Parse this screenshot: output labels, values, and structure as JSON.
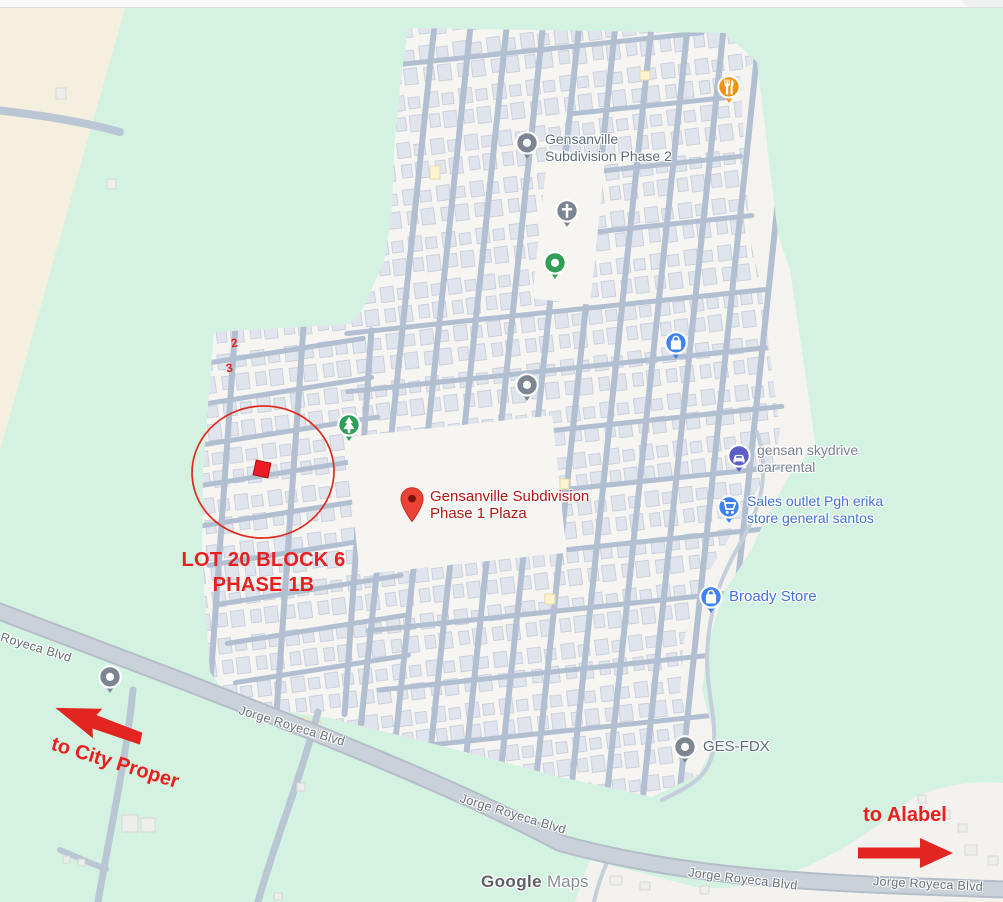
{
  "attribution": {
    "brand": "Google",
    "product": "Maps"
  },
  "road": {
    "jorge_royeca": "Jorge Royeca Blvd"
  },
  "pois": {
    "bogarts": {
      "name": "Bogart's Delectables"
    },
    "phase2_top": {
      "line1": "Gensanville",
      "line2": "Subdivision Phase 2"
    },
    "chapel": {
      "line1": "Gensanville Subdivision",
      "line2": "Phase 2 Chapel"
    },
    "basketball": {
      "line1": "Gensanville Subdivision",
      "line2": "Phase 2 Basketball Court"
    },
    "electrical": {
      "line1": "Gensan Online",
      "line2": "Electrical Sales"
    },
    "phase2_mid": {
      "line1": "Gensanville",
      "line2": "Subdivision Phase 2"
    },
    "plaza": {
      "line1": "Gensanville Subdivision",
      "line2": "Phase 1 Plaza"
    },
    "skydrive": {
      "line1": "gensan skydrive",
      "line2": "car rental"
    },
    "sales_outlet": {
      "line1": "Sales outlet Pgh erika",
      "line2": "store general santos"
    },
    "broady": {
      "name": "Broady Store"
    },
    "radyo": {
      "name": "Radyo GenSan"
    },
    "ges_fdx": {
      "name": "GES-FDX"
    }
  },
  "annotations": {
    "lot_line1": "LOT 20 BLOCK 6",
    "lot_line2": "PHASE 1B",
    "to_city_proper": "to City Proper",
    "to_alabel": "to Alabel",
    "block_number_2": "2",
    "block_number_3": "3"
  },
  "icons": {
    "restaurant": "fork-knife-icon",
    "generic_place": "dot-pin-icon",
    "chapel": "cross-pin-icon",
    "sports_court": "dot-pin-icon",
    "park": "tree-pin-icon",
    "shopping_bag": "bag-pin-icon",
    "shopping_cart": "cart-pin-icon",
    "car_rental": "car-pin-icon",
    "destination": "red-marker-icon"
  },
  "colors": {
    "terrain_green": "#d4f2e1",
    "field_beige": "#f4efdf",
    "subdivision_bg": "#f6f5f2",
    "building": "#e0e4ec",
    "street": "#b1bfd1",
    "boulevard": "#cad1d9",
    "poi_blue": "#4274dd",
    "poi_green": "#1e8e3e",
    "poi_orange": "#d9750e",
    "poi_gray": "#5f6d78",
    "destination_red": "#ea4335",
    "annotation_red": "#e8201f"
  }
}
